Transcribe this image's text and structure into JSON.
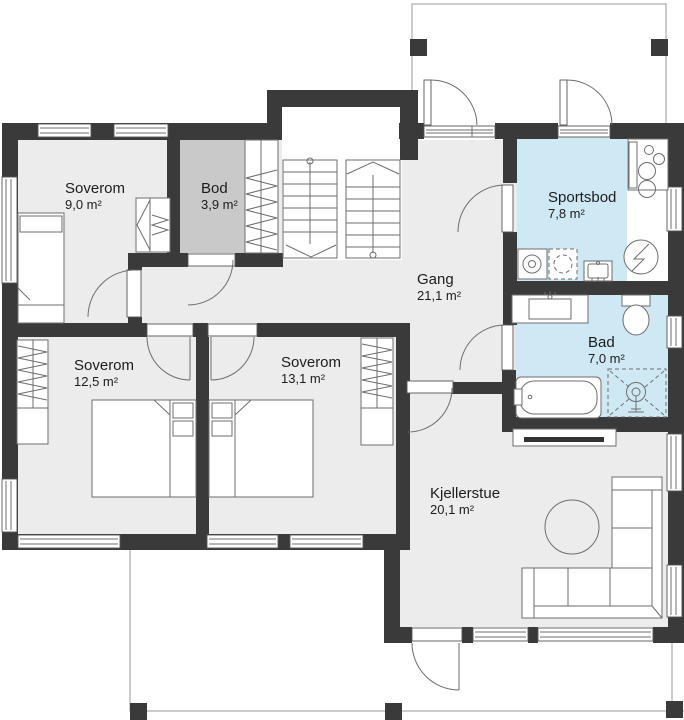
{
  "title": "Kjellerplan / basement floor plan",
  "rooms": {
    "soverom_9": {
      "name": "Soverom",
      "area": "9,0 m²"
    },
    "bod": {
      "name": "Bod",
      "area": "3,9 m²"
    },
    "sportsbod": {
      "name": "Sportsbod",
      "area": "7,8 m²"
    },
    "gang": {
      "name": "Gang",
      "area": "21,1 m²"
    },
    "bad": {
      "name": "Bad",
      "area": "7,0 m²"
    },
    "soverom_12": {
      "name": "Soverom",
      "area": "12,5 m²"
    },
    "soverom_13": {
      "name": "Soverom",
      "area": "13,1 m²"
    },
    "kjellerstue": {
      "name": "Kjellerstue",
      "area": "20,1 m²"
    }
  },
  "colors": {
    "wall": "#3a3a3a",
    "floor": "#ececec",
    "wet_room": "#cfe9f4",
    "storage": "#c9c9c9",
    "line": "#6e6e6e"
  }
}
